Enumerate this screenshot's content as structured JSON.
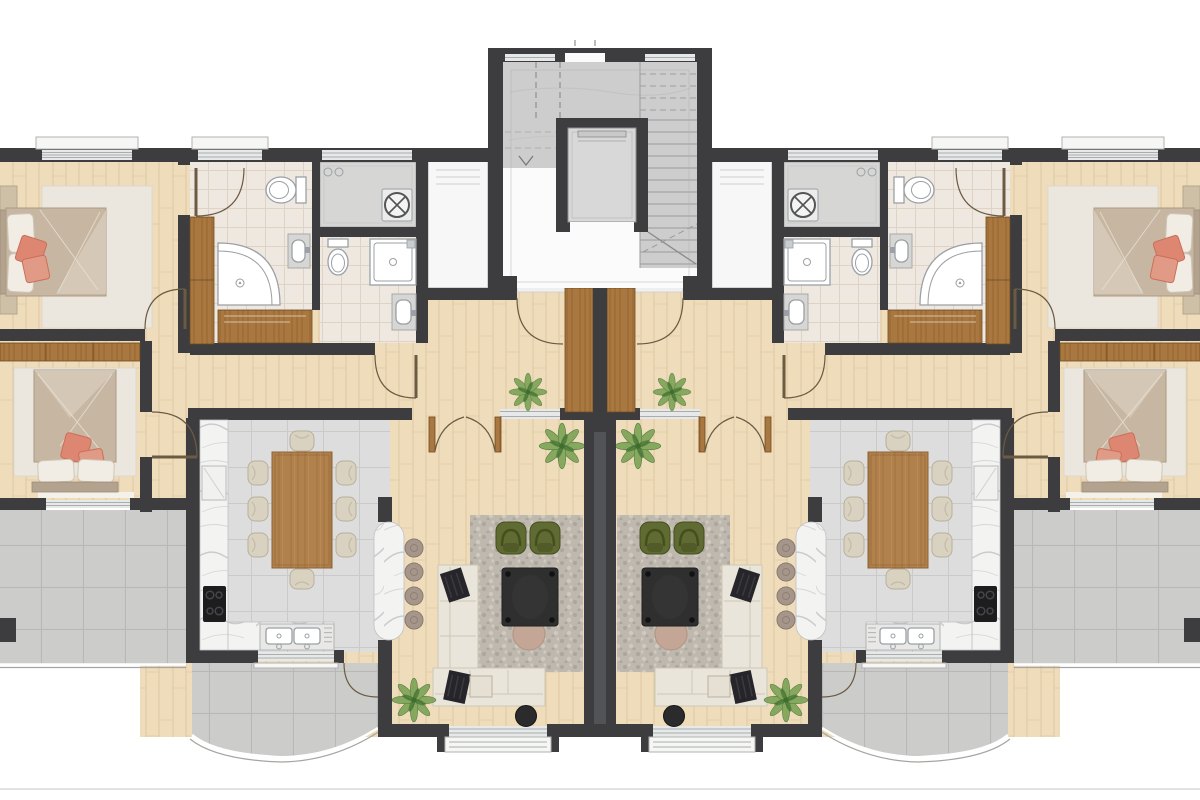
{
  "plan": {
    "type": "architectural-floor-plan",
    "layout": "two mirrored apartments around central stair-elevator core",
    "units": [
      {
        "id": "unit-left",
        "rooms": [
          "bedroom-primary",
          "ensuite-bathroom",
          "utility-room",
          "bathroom",
          "bedroom-secondary",
          "hallway",
          "kitchen-dining",
          "living-room",
          "side-terrace",
          "curved-balcony"
        ],
        "fixtures": [
          "double-bed",
          "double-bed",
          "wardrobe",
          "closet",
          "vanity-counter",
          "quarter-shower",
          "corner-shower",
          "toilet",
          "toilet",
          "washing-machine",
          "sink-vanity",
          "sink-vanity",
          "dining-table",
          "dining-chair x8",
          "kitchen-island",
          "bar-stool x4",
          "cooktop",
          "double-sink",
          "fridge",
          "sectional-sofa",
          "armchair x2",
          "coffee-table",
          "side-table",
          "ottoman",
          "rug x3",
          "plant x3"
        ]
      },
      {
        "id": "unit-right",
        "mirror_of": "unit-left"
      }
    ],
    "core": {
      "rooms": [
        "stairwell",
        "elevator",
        "landing"
      ],
      "fixtures": [
        "staircase",
        "elevator-cab",
        "entry-door x2"
      ]
    }
  },
  "colors": {
    "wall": "#3d3d3f",
    "woodFloor": "#eedcba",
    "plankLine": "#d3b98c",
    "tileK": "#dcdddc",
    "tileKLine": "#c9cac9",
    "tileB": "#efe8e0",
    "tileBLine": "#ded3c4",
    "tileBal": "#cccdcb",
    "tileBalLine": "#b8b9b7",
    "rugBase": "#beb8ae",
    "rugSpot1": "#aca69c",
    "rugSpot2": "#cfc9c0",
    "rugCream": "#ebe7df",
    "marbleVein": "#c9cbce",
    "marbleBase": "#f3f3f2",
    "woodDoor": "#a97840",
    "woodDoorDark": "#8a5a28",
    "woodTable": "#b0814c",
    "wardrobeTan": "#cec0a6",
    "glass": "#e7e9e9",
    "glassLine": "#a9adb0",
    "sill": "#f6f6f5",
    "sillLine": "#b1b1b1",
    "fixture": "#ffffff",
    "fixtureLine": "#9aa0a5",
    "counter": "#d6d6d5",
    "bedBlanket": "#c7b6a1",
    "bedFold": "#d7cab8",
    "sheet": "#f1ede4",
    "headboard": "#b3a28d",
    "coral": "#dd8672",
    "coralDark": "#cc6f58",
    "coral2": "#e09a85",
    "sofa": "#eae5da",
    "sofaLine": "#cfc7b6",
    "armchair": "#5f6b33",
    "armchairDark": "#454f1d",
    "dark": "#2e2f2e",
    "tan": "#c3a695",
    "plant": "#74a050",
    "plantDark": "#3f6d2d",
    "stool": "#a5958a",
    "coreFloor": "#cdcdcd",
    "coreLower": "#fbfbfb",
    "cab": "#d8d8d8",
    "doorArc": "#6b5b43",
    "shaft": "#f7f7f7",
    "partyInner": "#515356",
    "thresh": "#efefef"
  }
}
